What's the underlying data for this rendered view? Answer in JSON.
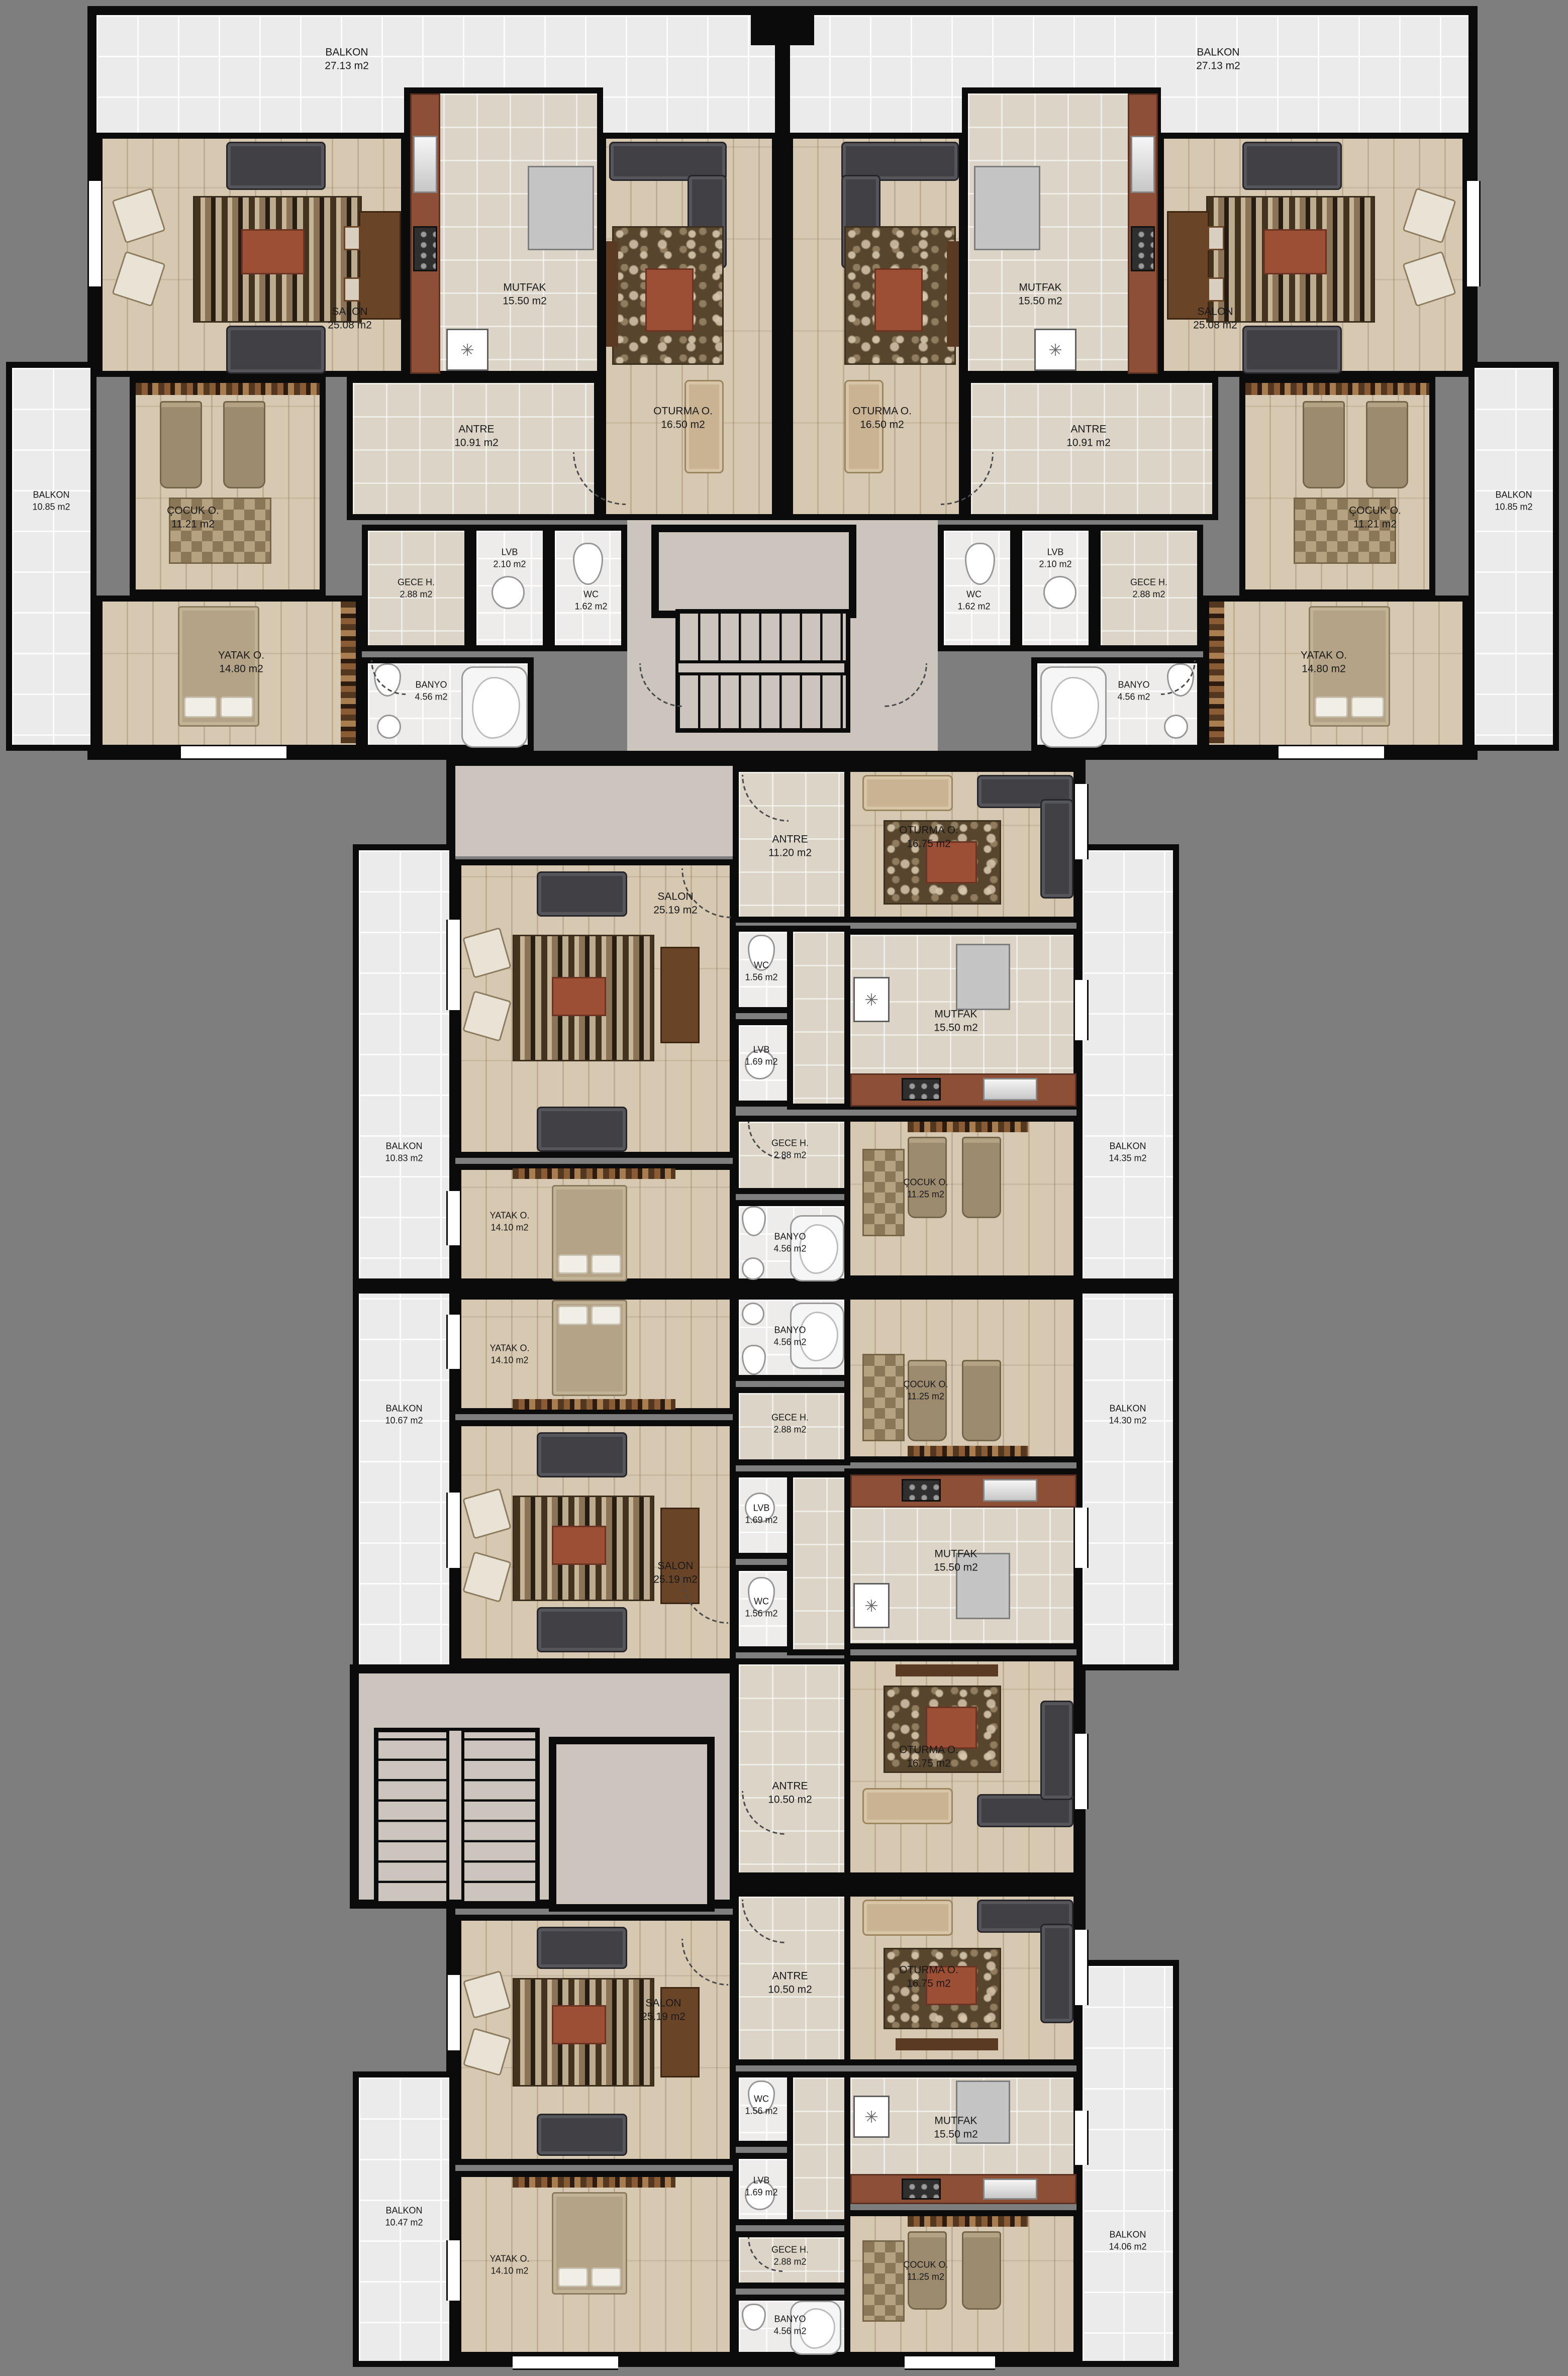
{
  "plan": {
    "type": "residential floor plan",
    "background_color": "#7e7e7e",
    "wall_color": "#0b0b0b",
    "accent_counter_color": "#8d5037"
  },
  "icons": {
    "refrigerator": "✳"
  },
  "rooms": {
    "balkon_a": {
      "name": "BALKON",
      "area": "27.13 m2"
    },
    "balkon_b": {
      "name": "BALKON",
      "area": "27.13 m2"
    },
    "salon_a": {
      "name": "SALON",
      "area": "25.08 m2"
    },
    "salon_b": {
      "name": "SALON",
      "area": "25.08 m2"
    },
    "mutfak_a": {
      "name": "MUTFAK",
      "area": "15.50 m2"
    },
    "mutfak_b": {
      "name": "MUTFAK",
      "area": "15.50 m2"
    },
    "oturma_a": {
      "name": "OTURMA O.",
      "area": "16.50 m2"
    },
    "oturma_b": {
      "name": "OTURMA O.",
      "area": "16.50 m2"
    },
    "antre_a": {
      "name": "ANTRE",
      "area": "10.91 m2"
    },
    "antre_b": {
      "name": "ANTRE",
      "area": "10.91 m2"
    },
    "balkon_side_a": {
      "name": "BALKON",
      "area": "10.85 m2"
    },
    "balkon_side_b": {
      "name": "BALKON",
      "area": "10.85 m2"
    },
    "cocuk_a": {
      "name": "ÇOCUK O.",
      "area": "11.21 m2"
    },
    "cocuk_b": {
      "name": "ÇOCUK O.",
      "area": "11.21 m2"
    },
    "gece_a": {
      "name": "GECE H.",
      "area": "2.88 m2"
    },
    "gece_b": {
      "name": "GECE H.",
      "area": "2.88 m2"
    },
    "lvb_a": {
      "name": "LVB",
      "area": "2.10 m2"
    },
    "lvb_b": {
      "name": "LVB",
      "area": "2.10 m2"
    },
    "wc_a": {
      "name": "WC",
      "area": "1.62 m2"
    },
    "wc_b": {
      "name": "WC",
      "area": "1.62 m2"
    },
    "yatak_a": {
      "name": "YATAK O.",
      "area": "14.80 m2"
    },
    "yatak_b": {
      "name": "YATAK O.",
      "area": "14.80 m2"
    },
    "banyo_a": {
      "name": "BANYO",
      "area": "4.56 m2"
    },
    "banyo_b": {
      "name": "BANYO",
      "area": "4.56 m2"
    },
    "antre_c": {
      "name": "ANTRE",
      "area": "11.20 m2"
    },
    "oturma_c": {
      "name": "OTURMA O.",
      "area": "16.75 m2"
    },
    "salon_c": {
      "name": "SALON",
      "area": "25.19 m2"
    },
    "wc_c": {
      "name": "WC",
      "area": "1.56 m2"
    },
    "lvb_c": {
      "name": "LVB",
      "area": "1.69 m2"
    },
    "mutfak_c": {
      "name": "MUTFAK",
      "area": "15.50 m2"
    },
    "gece_c": {
      "name": "GECE H.",
      "area": "2.88 m2"
    },
    "cocuk_c": {
      "name": "ÇOCUK O.",
      "area": "11.25 m2"
    },
    "yatak_c": {
      "name": "YATAK O.",
      "area": "14.10 m2"
    },
    "banyo_c": {
      "name": "BANYO",
      "area": "4.56 m2"
    },
    "balkon_l_c": {
      "name": "BALKON",
      "area": "10.83 m2"
    },
    "balkon_r_c": {
      "name": "BALKON",
      "area": "14.35 m2"
    },
    "yatak_d": {
      "name": "YATAK O.",
      "area": "14.10 m2"
    },
    "banyo_d": {
      "name": "BANYO",
      "area": "4.56 m2"
    },
    "cocuk_d": {
      "name": "ÇOCUK O.",
      "area": "11.25 m2"
    },
    "gece_d": {
      "name": "GECE H.",
      "area": "2.88 m2"
    },
    "lvb_d": {
      "name": "LVB",
      "area": "1.69 m2"
    },
    "wc_d": {
      "name": "WC",
      "area": "1.56 m2"
    },
    "salon_d": {
      "name": "SALON",
      "area": "25.19 m2"
    },
    "mutfak_d": {
      "name": "MUTFAK",
      "area": "15.50 m2"
    },
    "oturma_d": {
      "name": "OTURMA O.",
      "area": "16.75 m2"
    },
    "antre_d": {
      "name": "ANTRE",
      "area": "10.50 m2"
    },
    "balkon_l_d": {
      "name": "BALKON",
      "area": "10.67 m2"
    },
    "balkon_r_d": {
      "name": "BALKON",
      "area": "14.30 m2"
    },
    "oturma_e": {
      "name": "OTURMA O.",
      "area": "16.75 m2"
    },
    "antre_e": {
      "name": "ANTRE",
      "area": "10.50 m2"
    },
    "salon_e": {
      "name": "SALON",
      "area": "25.19 m2"
    },
    "wc_e": {
      "name": "WC",
      "area": "1.56 m2"
    },
    "lvb_e": {
      "name": "LVB",
      "area": "1.69 m2"
    },
    "mutfak_e": {
      "name": "MUTFAK",
      "area": "15.50 m2"
    },
    "gece_e": {
      "name": "GECE H.",
      "area": "2.88 m2"
    },
    "cocuk_e": {
      "name": "ÇOCUK O.",
      "area": "11.25 m2"
    },
    "yatak_e": {
      "name": "YATAK O.",
      "area": "14.10 m2"
    },
    "banyo_e": {
      "name": "BANYO",
      "area": "4.56 m2"
    },
    "balkon_l_e": {
      "name": "BALKON",
      "area": "10.47 m2"
    },
    "balkon_r_e": {
      "name": "BALKON",
      "area": "14.06 m2"
    }
  }
}
